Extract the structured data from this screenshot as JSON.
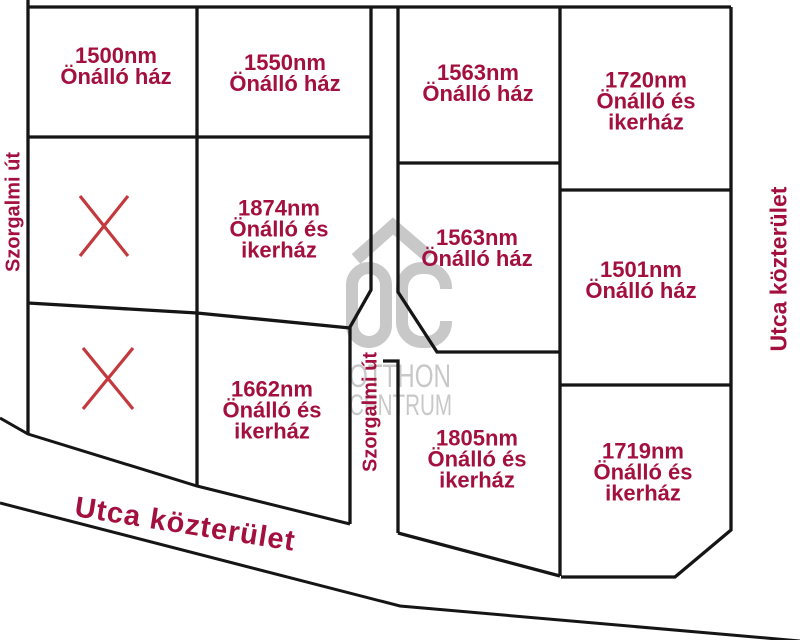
{
  "canvas": {
    "background": "#ffffff",
    "line_color": "#151515",
    "label_color": "#a3103f",
    "x_mark_color": "#c4393d",
    "watermark_color": "#c8c8c8"
  },
  "plots": [
    {
      "area": "1500nm",
      "type": "Önálló ház"
    },
    {
      "area": "1550nm",
      "type": "Önálló ház"
    },
    {
      "area": "1563nm",
      "type": "Önálló ház"
    },
    {
      "area": "1720nm",
      "type": "Önálló és ikerház"
    },
    {
      "area": "1874nm",
      "type": "Önálló és ikerház"
    },
    {
      "area": "1563nm",
      "type": "Önálló ház"
    },
    {
      "area": "1501nm",
      "type": "Önálló ház"
    },
    {
      "area": "1662nm",
      "type": "Önálló és ikerház"
    },
    {
      "area": "1805nm",
      "type": "Önálló és ikerház"
    },
    {
      "area": "1719nm",
      "type": "Önálló és ikerház"
    }
  ],
  "roads": {
    "left_road": "Szorgalmi út",
    "middle_road": "Szorgalmi út",
    "right_street": "Utca közterület",
    "bottom_street": "Utca közterület"
  },
  "watermark": {
    "monogram": "OC",
    "line1": "OTTHON",
    "line2": "CENTRUM"
  },
  "x_marks_count": 2
}
